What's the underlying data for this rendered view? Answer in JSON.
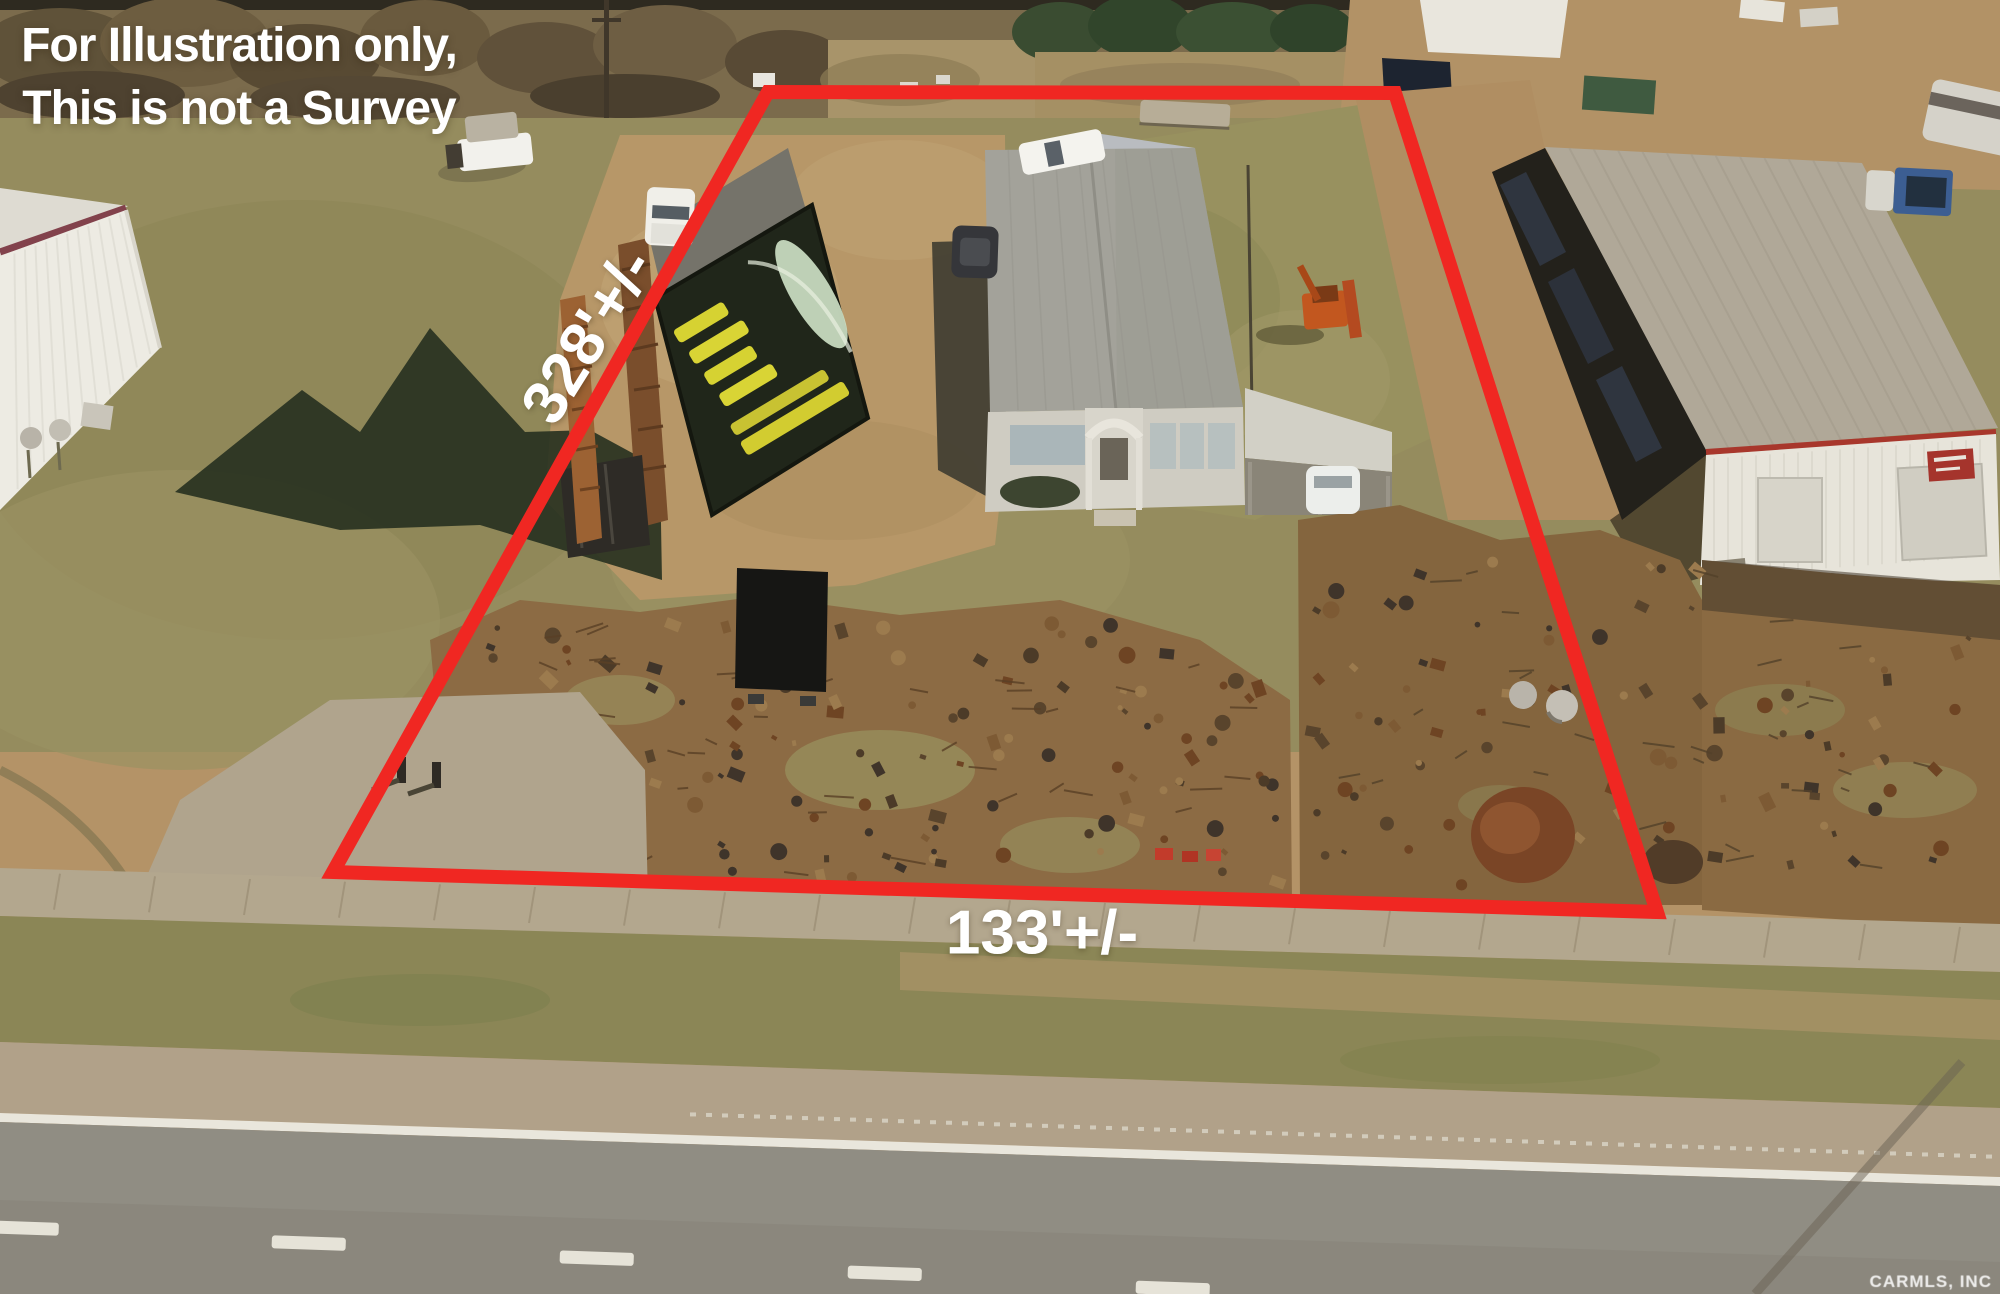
{
  "annotations": {
    "disclaimer": {
      "line1": "For Illustration only,",
      "line2": "This is not a Survey"
    },
    "dimensions": {
      "left_side": "328'+/-",
      "frontage": "133'+/-"
    },
    "boundary_color": "#f02722",
    "label_color": "#ffffff"
  },
  "watermark": {
    "text": "CARMLS, INC"
  }
}
